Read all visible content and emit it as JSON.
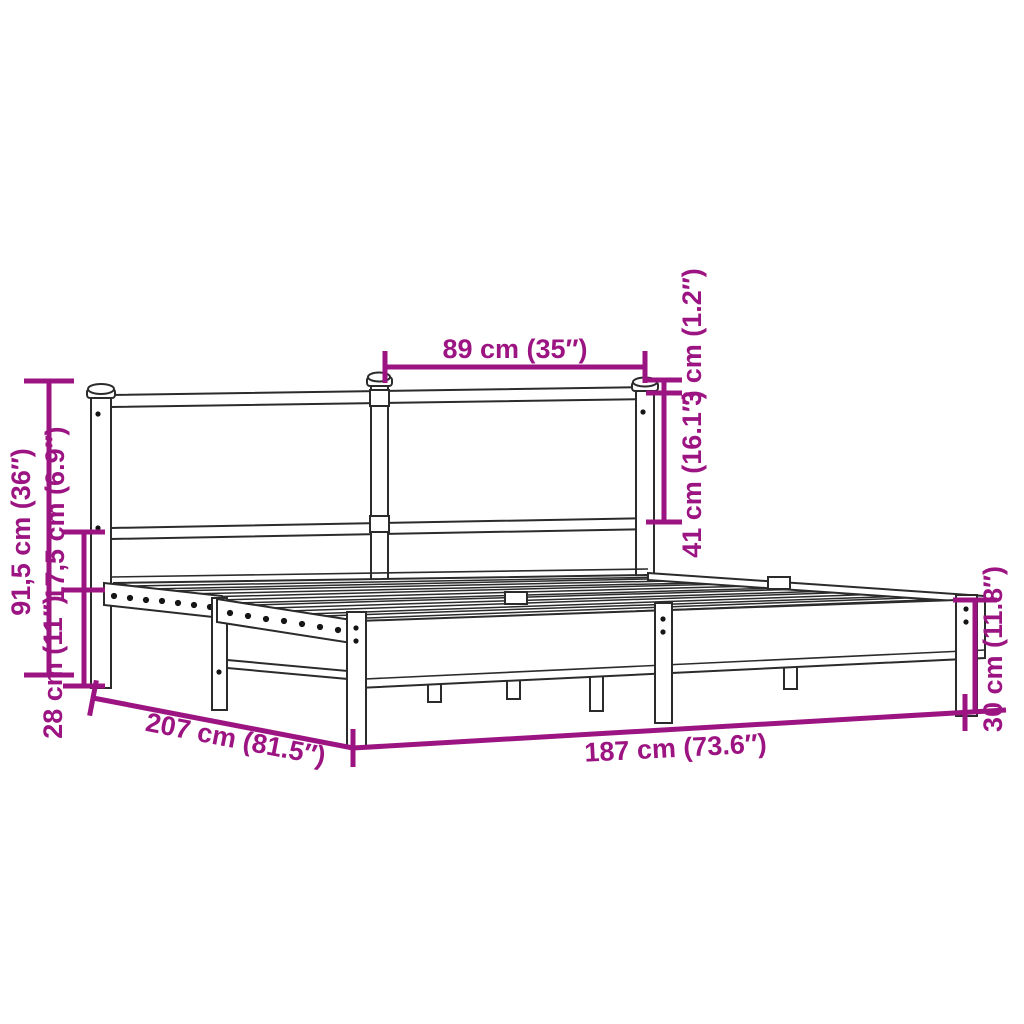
{
  "diagram": {
    "type": "product-dimension-diagram",
    "subject": "metal bed frame with headboard",
    "background_color": "#ffffff",
    "accent_color": "#9C1482",
    "line_color": "#2b2b2b",
    "dimensions": {
      "headboard_section_width": "89 cm (35″)",
      "headboard_rail_thickness": "3 cm (1.2″)",
      "headboard_panel_height": "41 cm (16.1″)",
      "total_height": "91,5 cm (36″)",
      "rail_to_platform_gap": "17,5 cm (6.9″)",
      "platform_height": "28 cm (11″)",
      "bed_length": "207 cm (81.5″)",
      "bed_width": "187 cm (73.6″)",
      "foot_end_height": "30 cm (11.8″)"
    }
  }
}
